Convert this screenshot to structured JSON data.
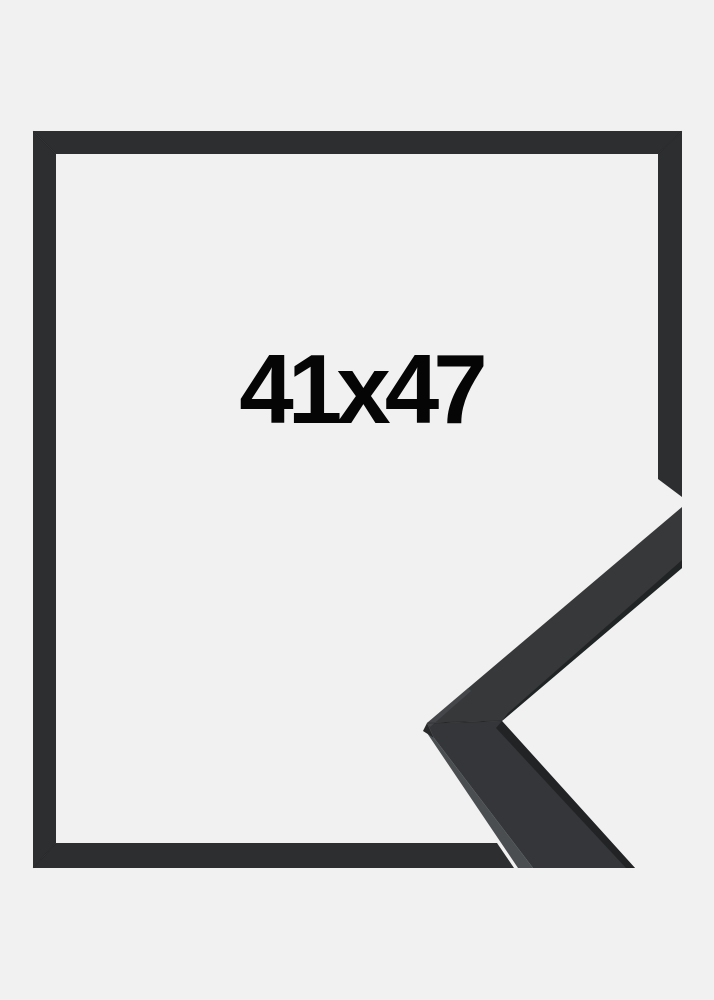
{
  "size_label": "41x47",
  "colors": {
    "background": "#f1f1f2",
    "frame": "#2c2e2f",
    "corner_face_upper": "#36383a",
    "corner_face_lower": "#343639",
    "corner_edge_dark": "#1f2122",
    "corner_side": "#4b4e51",
    "corner_chamfer": "#26282a",
    "corner_bevel_highlight": "#515457",
    "text": "#050505"
  }
}
